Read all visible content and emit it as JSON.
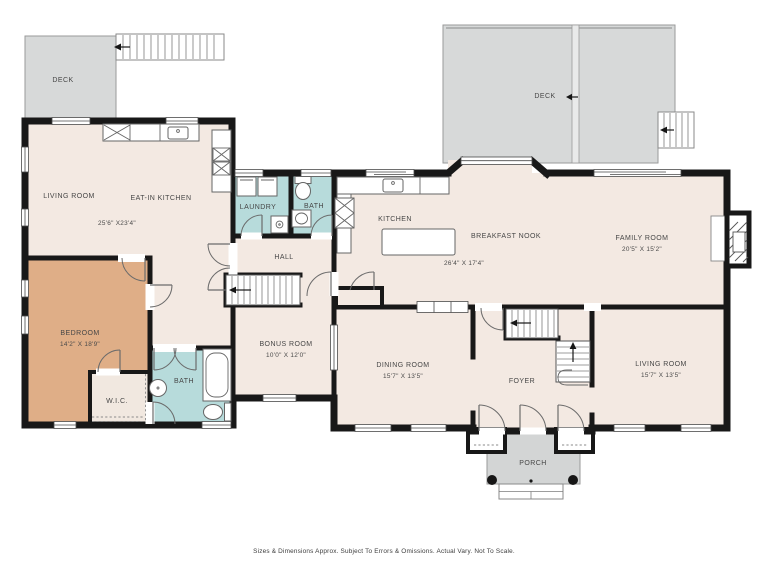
{
  "meta": {
    "type": "floor-plan"
  },
  "colors": {
    "wall": "#181818",
    "floor_cream": "#f3e9e2",
    "bedroom_tan": "#dfae87",
    "bath_teal": "#b7dbdb",
    "deck_gray": "#d7d9d9",
    "porch_gray": "#d3d5d5",
    "label_text": "#474747"
  },
  "rooms": {
    "deck_left": {
      "label": "DECK"
    },
    "deck_right": {
      "label": "DECK"
    },
    "living_upper": {
      "label": "LIVING ROOM",
      "dims": "25'6\" X23'4\""
    },
    "eat_in_kitchen": {
      "label": "EAT-IN KITCHEN"
    },
    "bedroom": {
      "label": "BEDROOM",
      "dims": "14'2\" X 18'9\""
    },
    "wic": {
      "label": "W.I.C."
    },
    "bath_lower": {
      "label": "BATH"
    },
    "laundry": {
      "label": "LAUNDRY"
    },
    "bath_upper": {
      "label": "BATH"
    },
    "hall": {
      "label": "HALL"
    },
    "bonus": {
      "label": "BONUS ROOM",
      "dims": "10'0\" X 12'0\""
    },
    "kitchen": {
      "label": "KITCHEN"
    },
    "breakfast_nook": {
      "label": "BREAKFAST NOOK",
      "dims": "26'4\" X 17'4\""
    },
    "family": {
      "label": "FAMILY ROOM",
      "dims": "20'5\" X 15'2\""
    },
    "dining": {
      "label": "DINING ROOM",
      "dims": "15'7\" X 13'5\""
    },
    "foyer": {
      "label": "FOYER"
    },
    "living_lower": {
      "label": "LIVING ROOM",
      "dims": "15'7\" X 13'5\""
    },
    "porch": {
      "label": "PORCH"
    }
  },
  "footer": {
    "disclaimer": "Sizes & Dimensions Approx. Subject To Errors & Omissions. Actual Vary. Not To Scale."
  }
}
